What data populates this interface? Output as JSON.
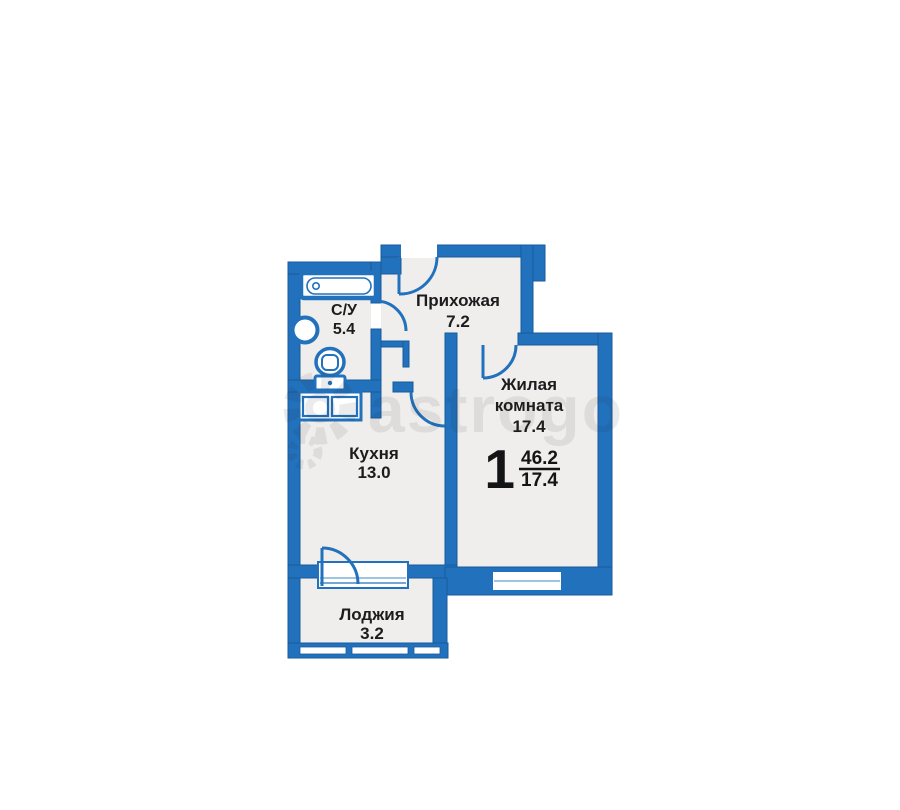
{
  "rooms": {
    "bathroom": {
      "label": "С/У",
      "area": "5.4"
    },
    "hallway": {
      "label": "Прихожая",
      "area": "7.2"
    },
    "living": {
      "label_line1": "Жилая",
      "label_line2": "комната",
      "area": "17.4"
    },
    "kitchen": {
      "label": "Кухня",
      "area": "13.0"
    },
    "loggia": {
      "label": "Лоджия",
      "area": "3.2"
    }
  },
  "summary": {
    "rooms_count": "1",
    "total_area": "46.2",
    "living_area": "17.4"
  },
  "watermark": {
    "text": "astrogo"
  },
  "colors": {
    "wall": "#2271bd",
    "wall_edge": "#1a5b9c",
    "room_fill": "#efeeec",
    "text": "#1c1c1e"
  }
}
